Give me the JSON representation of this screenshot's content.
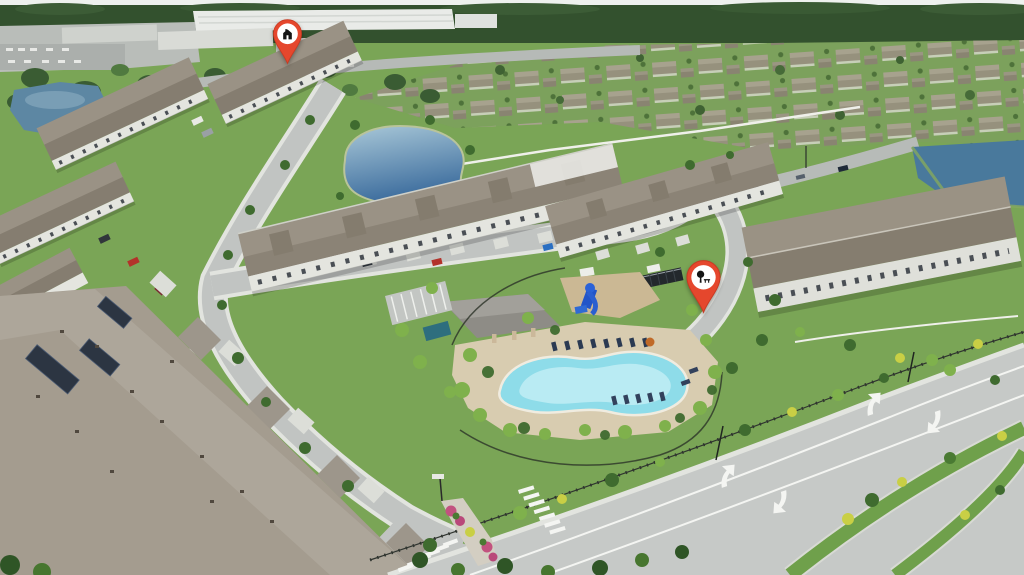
{
  "scene": {
    "type": "aerial-drone-photo",
    "subject": "Aerial view of a suburban townhome community with amenity pool, ponds, divided boulevard and two location map pins",
    "landmarks": [
      "distribution-warehouse",
      "retail-buildings",
      "single-family-neighborhood",
      "small-pond",
      "central-pond",
      "roadside-pond",
      "townhome-rows",
      "solar-panel-roof",
      "community-pool",
      "pool-deck",
      "clubhouse",
      "playground-slide",
      "lounge-chairs",
      "dumpster-row",
      "parking-lot",
      "divided-boulevard",
      "grass-medians",
      "turn-arrows",
      "crosswalks",
      "entrance-median-island",
      "palm-trees",
      "pink-flower-beds"
    ]
  },
  "pins": {
    "home": {
      "label": "Property location pin",
      "glyph": "house-icon",
      "pin_color": "#e5472d",
      "pin_edge": "#c93a22",
      "badge_color": "#ffffff",
      "glyph_color": "#151515"
    },
    "park": {
      "label": "Community amenity pin",
      "glyph": "park-tree-bench-icon",
      "pin_color": "#e5472d",
      "pin_edge": "#c93a22",
      "badge_color": "#ffffff",
      "glyph_color": "#151515"
    }
  },
  "palette": {
    "sky": "#eef1ee",
    "treeline": "#33512e",
    "distant_grass": "#7ca15c",
    "warehouse": "#e9ebe8",
    "road": "#c1c4c2",
    "boulevard": "#c6c9c7",
    "sidewalk": "#e2e4df",
    "grass": "#7aa556",
    "pond_light": "#a9c8d8",
    "pond_deep": "#38699b",
    "pond_small": "#5d87a3",
    "pond_right": "#49799c",
    "pool_water": "#8edce9",
    "pool_inner": "#c4eff5",
    "pool_deck": "#d8ccb0",
    "roof": "#9a9285",
    "roof_dark": "#857d70",
    "roof_foreground": "#a49c8f",
    "wall": "#e4e5df",
    "solar_panel": "#2c3542",
    "lane_marking": "#f4f5f2",
    "median_grass": "#6fa04b",
    "shrub_yellow": "#c9cf45",
    "palm_dark": "#3f6b2f",
    "palm_light": "#7fb14c",
    "flower_pink": "#c2527f",
    "fence_dark": "#2f342f",
    "wall_white": "#eff0ea"
  }
}
